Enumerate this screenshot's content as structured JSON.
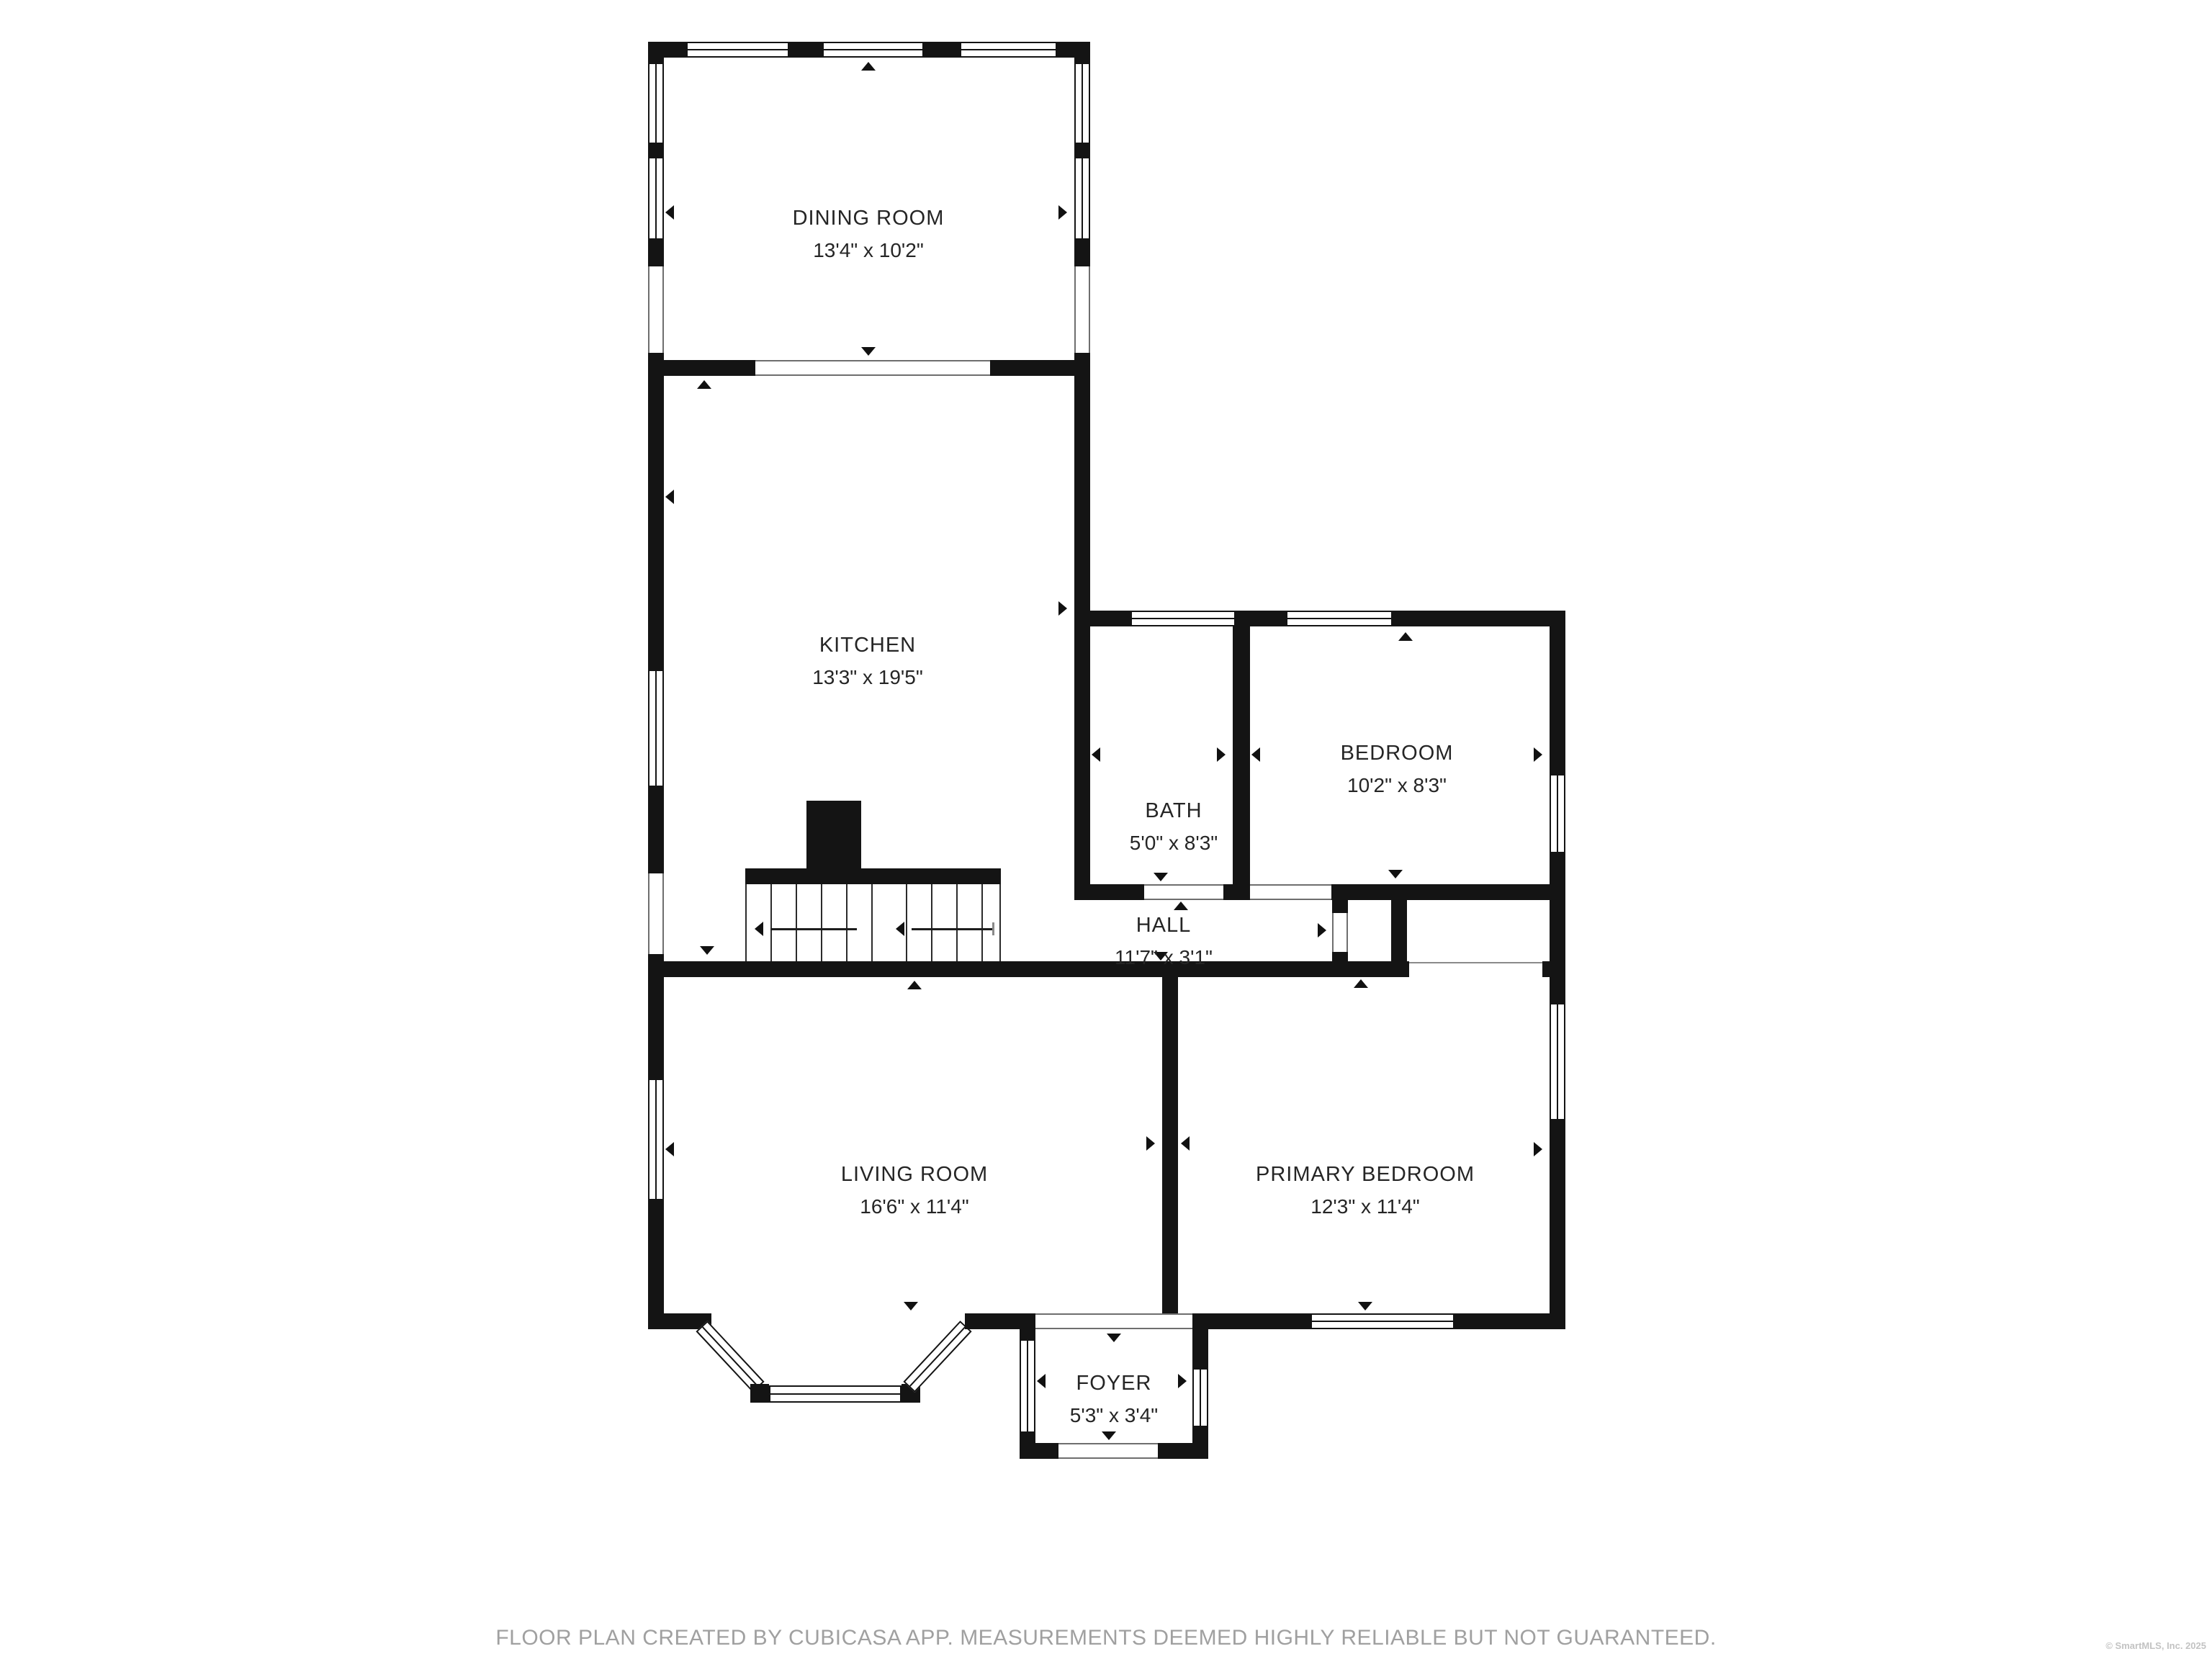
{
  "plan": {
    "rooms": {
      "dining": {
        "name": "DINING ROOM",
        "dims": "13'4\" x 10'2\""
      },
      "kitchen": {
        "name": "KITCHEN",
        "dims": "13'3\" x 19'5\""
      },
      "bath": {
        "name": "BATH",
        "dims": "5'0\" x 8'3\""
      },
      "bedroom": {
        "name": "BEDROOM",
        "dims": "10'2\" x 8'3\""
      },
      "hall": {
        "name": "HALL",
        "dims": "11'7\" x 3'1\""
      },
      "living": {
        "name": "LIVING ROOM",
        "dims": "16'6\" x 11'4\""
      },
      "primary": {
        "name": "PRIMARY BEDROOM",
        "dims": "12'3\" x 11'4\""
      },
      "foyer": {
        "name": "FOYER",
        "dims": "5'3\" x 3'4\""
      }
    }
  },
  "footer": {
    "disclaimer": "FLOOR PLAN CREATED BY CUBICASA APP. MEASUREMENTS DEEMED HIGHLY RELIABLE BUT NOT GUARANTEED."
  },
  "credits": {
    "copyright": "© SmartMLS, Inc.  2025"
  },
  "colors": {
    "wall": "#141414",
    "label": "#252525",
    "footer": "#a0a0a0"
  }
}
